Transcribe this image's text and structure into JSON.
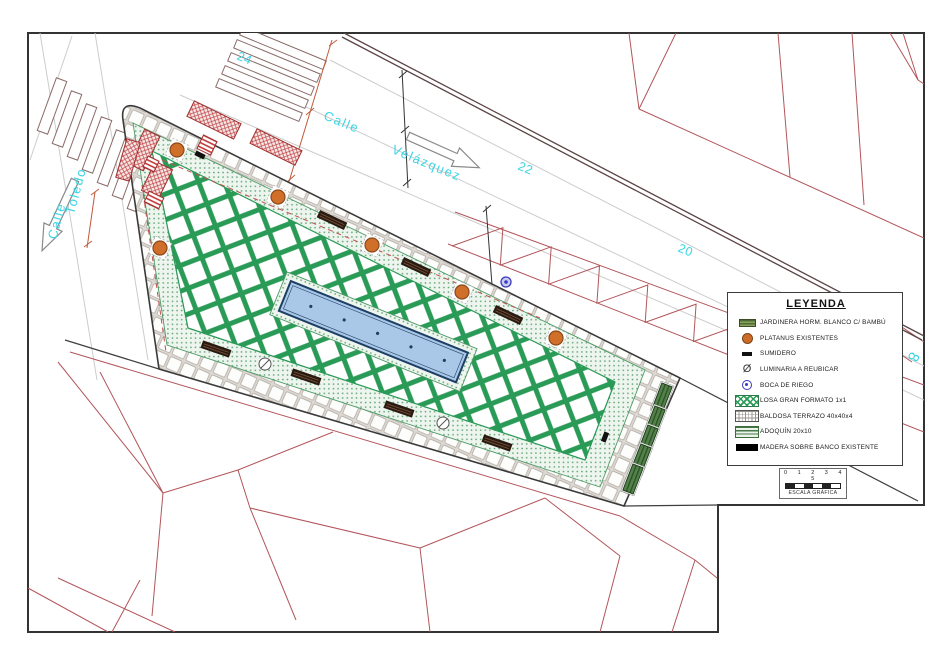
{
  "labels": {
    "calle_velazquez_1": "Calle",
    "calle_velazquez_2": "Velázquez",
    "calle_toledo_1": "Calle",
    "calle_toledo_2": "Toledo",
    "num_24": "24",
    "num_22": "22",
    "num_20": "20",
    "num_partial": "8"
  },
  "legend": {
    "title": "LEYENDA",
    "items": [
      {
        "label": "JARDINERA HORM. BLANCO C/ BAMBÚ",
        "icon": "jardinera-swatch"
      },
      {
        "label": "PLATANUS EXISTENTES",
        "icon": "tree-circle"
      },
      {
        "label": "SUMIDERO",
        "icon": "drain-rect"
      },
      {
        "label": "LUMINARIA A REUBICAR",
        "icon": "diameter-glyph",
        "glyph": "Ø"
      },
      {
        "label": "BOCA DE RIEGO",
        "icon": "hydrant-circle"
      },
      {
        "label": "LOSA GRAN FORMATO 1x1",
        "icon": "lattice-swatch"
      },
      {
        "label": "BALDOSA TERRAZO 40x40x4",
        "icon": "terrazzo-grid-swatch"
      },
      {
        "label": "ADOQUÍN 20x10",
        "icon": "paver-swatch"
      },
      {
        "label": "MADERA SOBRE BANCO EXISTENTE",
        "icon": "solid-black-swatch"
      }
    ]
  },
  "scale_bar": {
    "numbers": "0 1 2 3 4 5",
    "label": "ESCALA GRÁFICA"
  },
  "colors": {
    "street_label_cyan": "#3bd5e4",
    "parcel_red": "#b2555a",
    "lattice_green": "#2a9a57",
    "pool_blue": "#a9c7e6",
    "tree_orange": "#d06f2a",
    "kiosk_red": "#c04040",
    "frame_black": "#333333"
  }
}
